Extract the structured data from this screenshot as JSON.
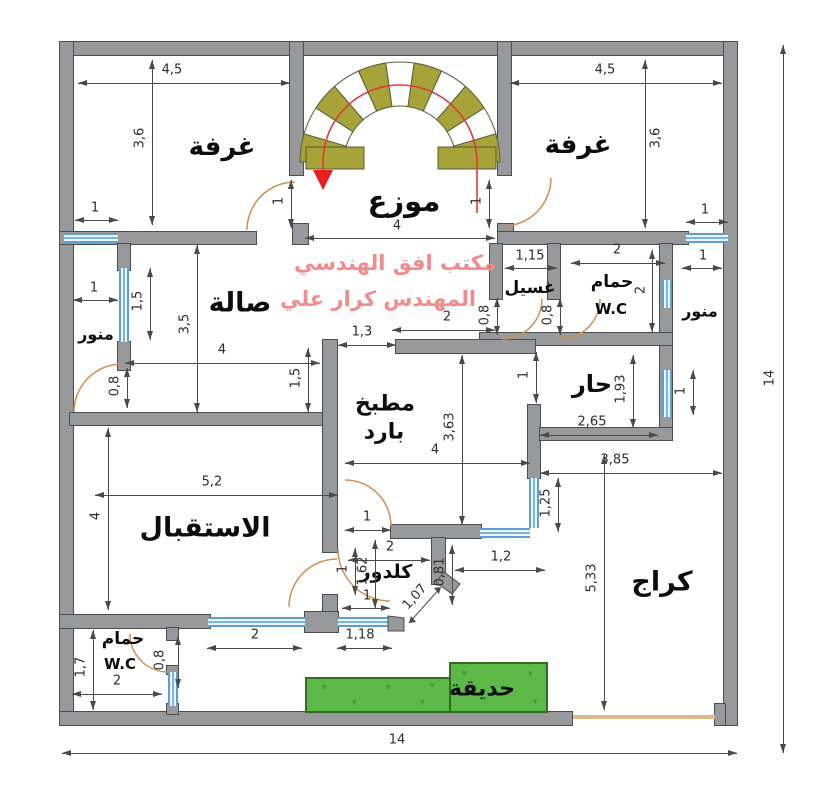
{
  "watermark": {
    "line1": "مكتب افق الهندسي",
    "line2": "المهندس كرار علي",
    "color": "#f28b8b"
  },
  "rooms": {
    "bedroom_left": "غرفة",
    "bedroom_right": "غرفة",
    "hall_distributor": "موزع",
    "living": "صالة",
    "laundry": "غسيل",
    "bath1": "حمام",
    "bath1_wc": "W.C",
    "lightwell_left": "منور",
    "lightwell_right": "منور",
    "hot_room": "حار",
    "kitchen_line1": "مطبخ",
    "kitchen_line2": "بارد",
    "reception": "الاستقبال",
    "corridor": "كلدور",
    "garage": "كراج",
    "bath2": "حمام",
    "bath2_wc": "W.C",
    "garden": "حديقة"
  },
  "dims": {
    "bl_w": "4,5",
    "bl_h": "3,6",
    "bl_win": "1",
    "bl_door": "1",
    "br_w": "4,5",
    "br_h": "3,6",
    "br_win": "1",
    "br_door": "1",
    "hall_w": "4",
    "hall_open": "2",
    "laundry_w": "1,15",
    "laundry_door": "0,8",
    "bath1_w": "2",
    "bath1_h": "2",
    "bath1_door": "0,8",
    "lwr_gap": "1",
    "lwr_win2": "1",
    "lwl_gap": "1",
    "lwl_win": "1,5",
    "lwl_door": "0,8",
    "living_w": "4",
    "living_h": "3,5",
    "living_r": "1,5",
    "kt_open": "1,3",
    "kitchen_h": "3,63",
    "kitchen_w": "4",
    "kitchen_r": "1",
    "kitchen_win": "1,25",
    "kitchen_door": "1",
    "hot_h": "1,93",
    "hot_w": "2,65",
    "garage_w": "3,85",
    "garage_h": "5,33",
    "recep_w": "5,2",
    "recep_h": "4",
    "recep_door": "1",
    "recep_door2": "1,62",
    "recep_win": "2",
    "cor_w": "2",
    "cor_open": "1",
    "cor_diag": "1,07",
    "cor_r": "0,81",
    "cor_right": "1,2",
    "cor_win": "1,18",
    "wc_h": "1,7",
    "wc_w": "2",
    "wc_door": "0,8",
    "total_w": "14",
    "total_h": "14"
  },
  "colors": {
    "wall": "#97999b",
    "window": "#79b6e0",
    "door_arc": "#cf9152",
    "stairs": "#a6a339",
    "garden": "#5cb847",
    "watermark": "#f28b8b",
    "stair_arrow": "#e81f1f"
  }
}
